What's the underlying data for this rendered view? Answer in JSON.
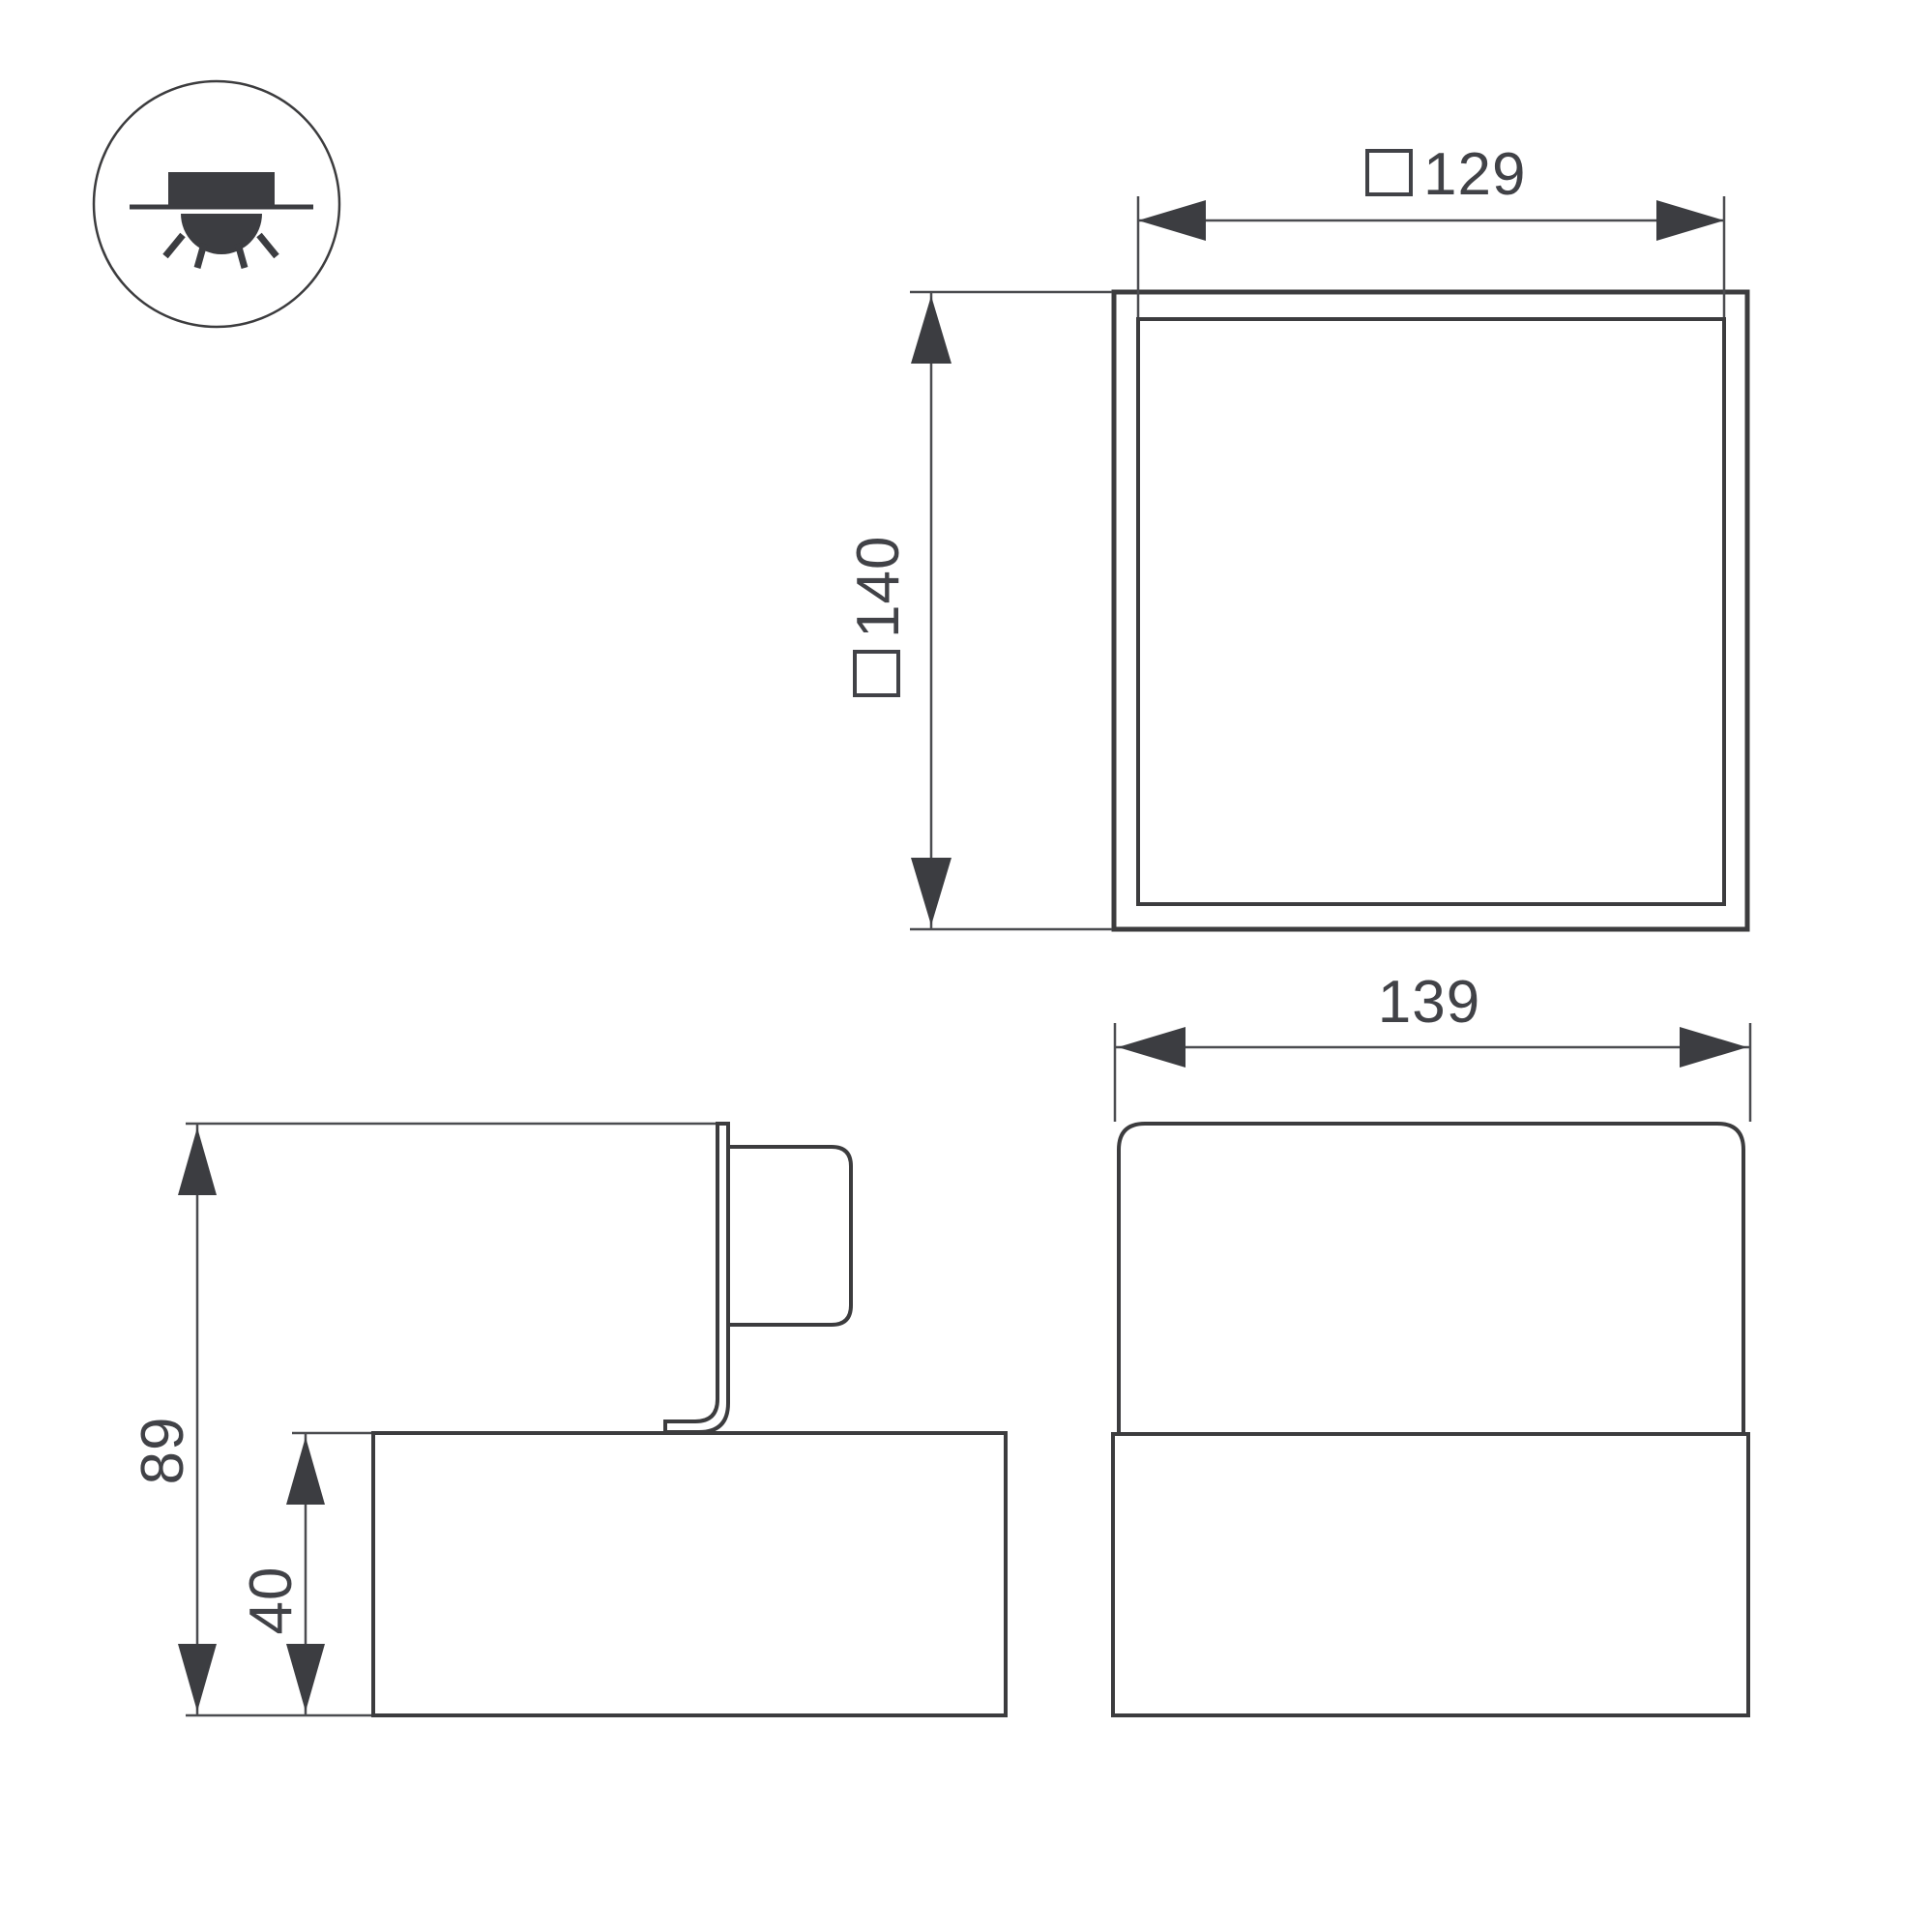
{
  "page": {
    "background": "#ffffff",
    "description_visible_text_only": true
  },
  "colors": {
    "outline": "#3c3c3e",
    "dimension_lines": "#4b4c50",
    "text": "#414247",
    "background": "#ffffff"
  },
  "mount_icon": {
    "name": "surface-ceiling-mount-light-icon",
    "ray_count": 4
  },
  "dimensions": {
    "d129": {
      "square_prefix": "□",
      "value": "129"
    },
    "d140": {
      "square_prefix": "□",
      "value": "140"
    },
    "d139": {
      "value": "139"
    },
    "d89": {
      "value": "89"
    },
    "d40": {
      "value": "40"
    }
  }
}
